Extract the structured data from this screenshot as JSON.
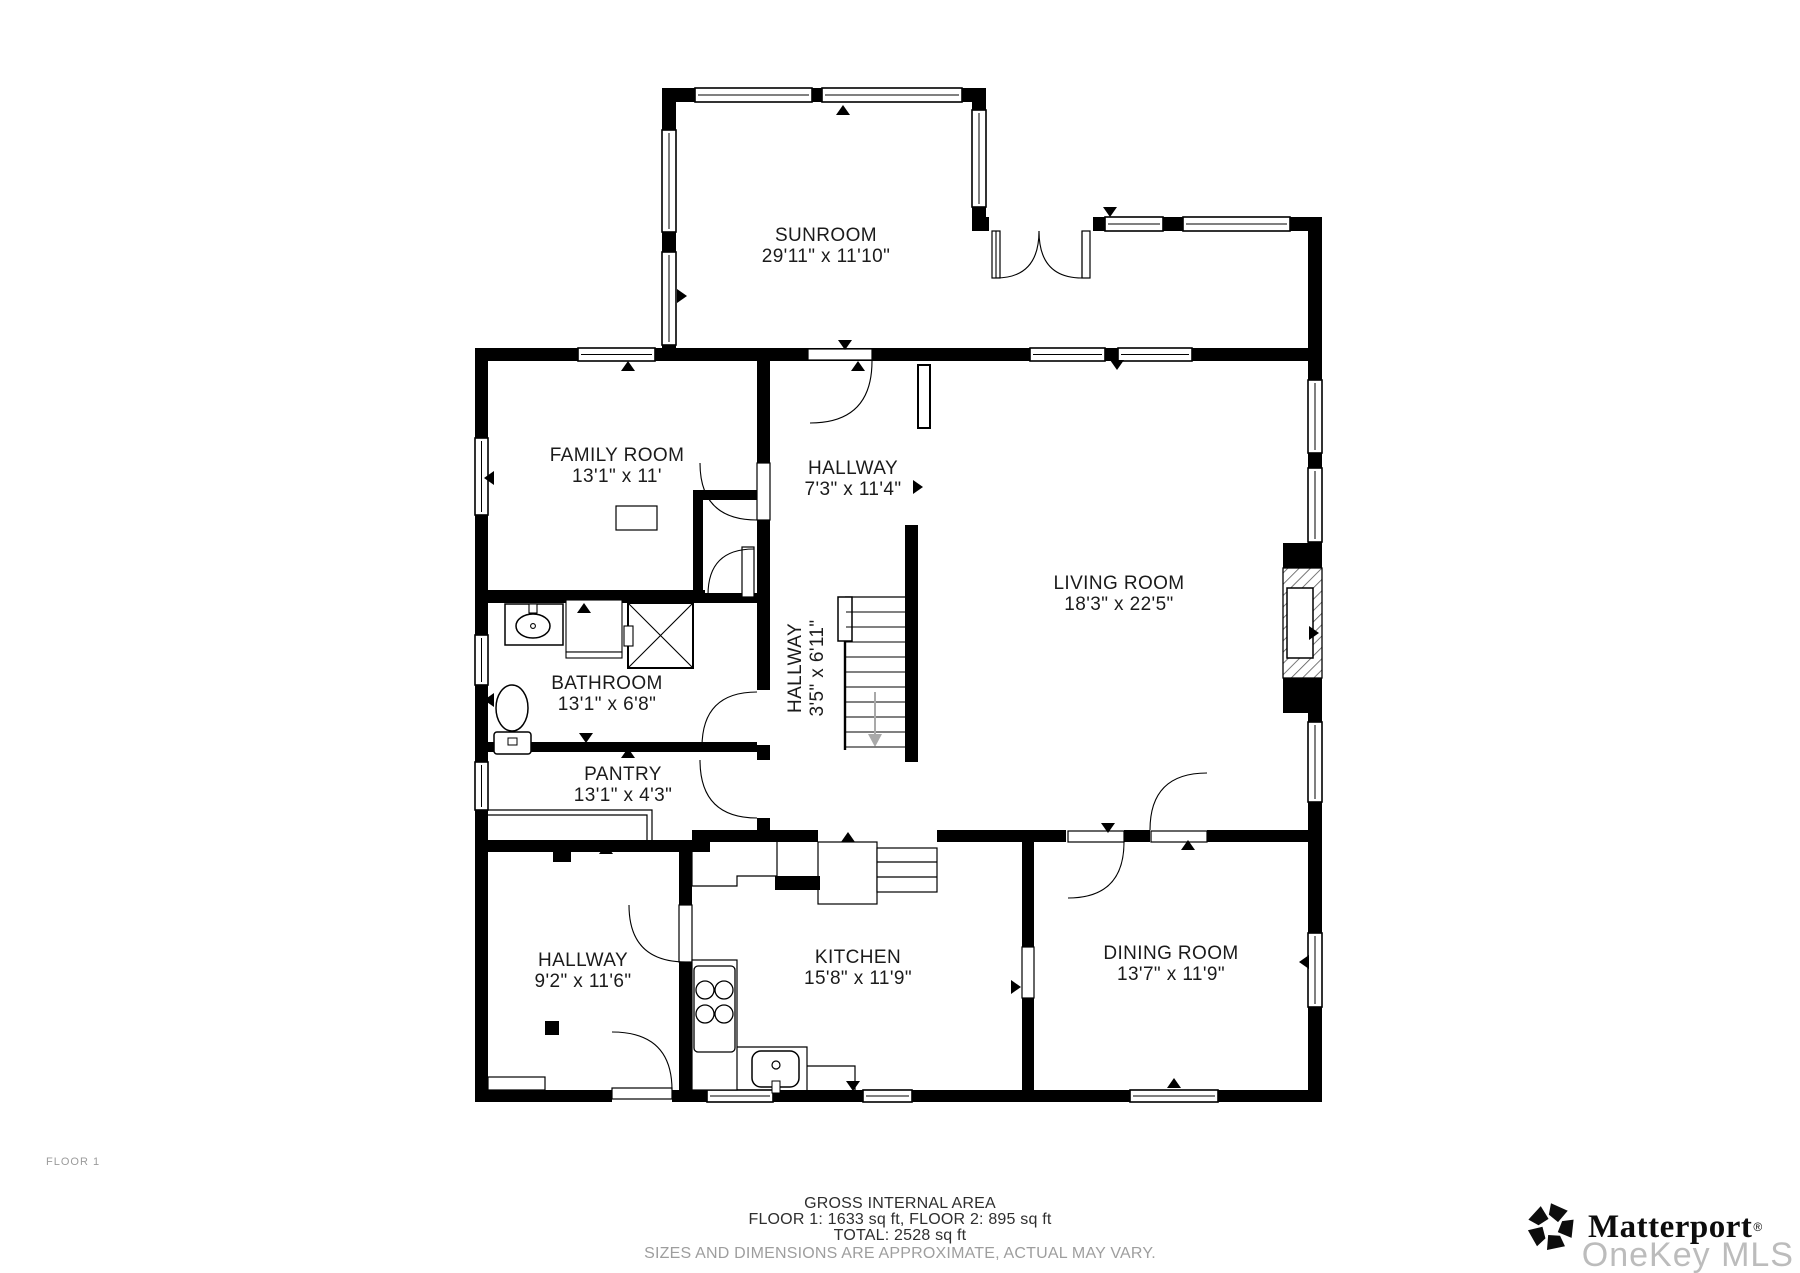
{
  "floor_label": "FLOOR 1",
  "rooms": [
    {
      "name": "SUNROOM",
      "dims": "29'11\" x 11'10\"",
      "x": 826,
      "y": 241,
      "rotate": 0
    },
    {
      "name": "FAMILY ROOM",
      "dims": "13'1\" x 11'",
      "x": 617,
      "y": 461,
      "rotate": 0
    },
    {
      "name": "HALLWAY",
      "dims": "7'3\" x 11'4\"",
      "x": 853,
      "y": 474,
      "rotate": 0
    },
    {
      "name": "LIVING ROOM",
      "dims": "18'3\" x 22'5\"",
      "x": 1119,
      "y": 589,
      "rotate": 0
    },
    {
      "name": "BATHROOM",
      "dims": "13'1\" x 6'8\"",
      "x": 607,
      "y": 689,
      "rotate": 0
    },
    {
      "name": "HALLWAY",
      "dims": "3'5\" x 6'11\"",
      "x": 807,
      "y": 668,
      "rotate": -90
    },
    {
      "name": "PANTRY",
      "dims": "13'1\" x 4'3\"",
      "x": 623,
      "y": 780,
      "rotate": 0
    },
    {
      "name": "HALLWAY",
      "dims": "9'2\" x 11'6\"",
      "x": 583,
      "y": 966,
      "rotate": 0
    },
    {
      "name": "KITCHEN",
      "dims": "15'8\" x 11'9\"",
      "x": 858,
      "y": 963,
      "rotate": 0
    },
    {
      "name": "DINING ROOM",
      "dims": "13'7\" x 11'9\"",
      "x": 1171,
      "y": 959,
      "rotate": 0
    }
  ],
  "footer": {
    "title": "GROSS INTERNAL AREA",
    "line1": "FLOOR 1: 1633 sq ft, FLOOR 2: 895 sq ft",
    "line2": "TOTAL: 2528 sq ft",
    "disclaimer": "SIZES AND DIMENSIONS ARE APPROXIMATE, ACTUAL MAY VARY."
  },
  "branding": {
    "logo_text": "Matterport",
    "registered": "®",
    "watermark": "OneKey MLS"
  },
  "colors": {
    "wall": "#000000",
    "floor": "#ffffff",
    "label": "#1b1b1b",
    "muted": "#9e9e9e",
    "watermark": "#bcbcbc"
  }
}
